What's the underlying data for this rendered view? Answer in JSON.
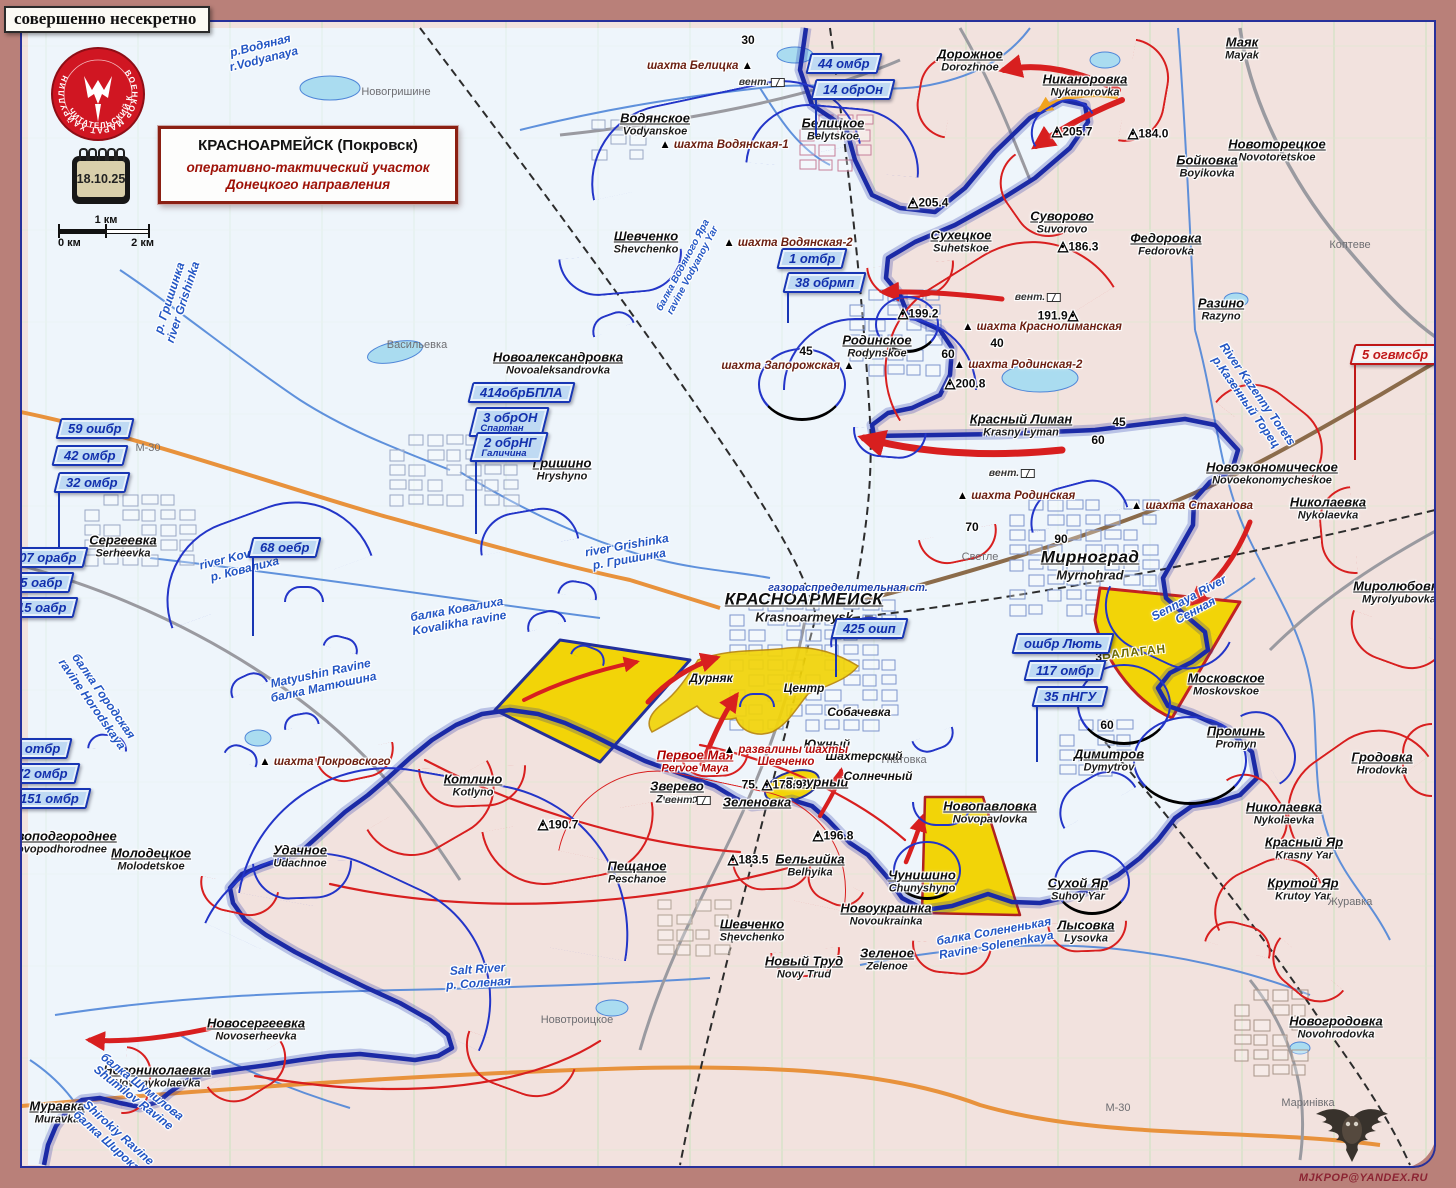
{
  "header": {
    "classification": "совершенно несекретно",
    "logo_line1": "ВОЕНКОР МАРАТ ХАЙРУЛЛИН",
    "logo_line2": "ЧИТАТЕЛЬСКИЙ КЛУБ",
    "date": "18.10.25",
    "title_line1": "КРАСНОАРМЕЙСК (Покровск)",
    "title_line2": "оперативно-тактический участок",
    "title_line3": "Донецкого направления",
    "scale": {
      "top": "1 км",
      "left": "0 км",
      "right": "2 км"
    },
    "watermark": "MJKPOP@YANDEX.RU"
  },
  "colors": {
    "front_line": "#1b2aa6",
    "enemy": "#d81f1f",
    "friendly": "#2335c8",
    "contested": "#f2d408",
    "ua_area": "#eef5fb",
    "ru_area": "#f2e2de",
    "frame": "#b98079"
  },
  "map": {
    "towns": [
      {
        "ru": "КРАСНОАРМЕЙСК",
        "en": "Krasnoarmeysk",
        "x": 804,
        "y": 607,
        "s": "lg"
      },
      {
        "ru": "Мирноград",
        "en": "Myrnohrad",
        "x": 1090,
        "y": 565,
        "s": "lg"
      },
      {
        "ru": "Дорожное",
        "en": "Dorozhnoe",
        "x": 970,
        "y": 60
      },
      {
        "ru": "Никаноровка",
        "en": "Nykanorovka",
        "x": 1085,
        "y": 85
      },
      {
        "ru": "Маяк",
        "en": "Mayak",
        "x": 1242,
        "y": 48
      },
      {
        "ru": "Новоторецкое",
        "en": "Novotoretskoe",
        "x": 1277,
        "y": 150
      },
      {
        "ru": "Бойковка",
        "en": "Boyikovka",
        "x": 1207,
        "y": 166
      },
      {
        "ru": "Суворово",
        "en": "Suvorovo",
        "x": 1062,
        "y": 222
      },
      {
        "ru": "Федоровка",
        "en": "Fedorovka",
        "x": 1166,
        "y": 244
      },
      {
        "ru": "Разино",
        "en": "Razyno",
        "x": 1221,
        "y": 309
      },
      {
        "ru": "Водянское",
        "en": "Vodyanskoe",
        "x": 655,
        "y": 124
      },
      {
        "ru": "Белицкое",
        "en": "Belytskoe",
        "x": 833,
        "y": 129
      },
      {
        "ru": "Сухецкое",
        "en": "Suhetskoe",
        "x": 961,
        "y": 241
      },
      {
        "ru": "Шевченко",
        "en": "Shevchenko",
        "x": 646,
        "y": 242
      },
      {
        "ru": "Родинское",
        "en": "Rodynskoe",
        "x": 877,
        "y": 346
      },
      {
        "ru": "Красный Лиман",
        "en": "Krasny Lyman",
        "x": 1021,
        "y": 425
      },
      {
        "ru": "Новоэкономическое",
        "en": "Novoekonomycheskoe",
        "x": 1272,
        "y": 473
      },
      {
        "ru": "Николаевка",
        "en": "Nykolaevka",
        "x": 1328,
        "y": 508
      },
      {
        "ru": "Миролюбовка",
        "en": "Myrolyubovka",
        "x": 1399,
        "y": 592
      },
      {
        "ru": "Новоалександровка",
        "en": "Novoaleksandrovka",
        "x": 558,
        "y": 363
      },
      {
        "ru": "Гришино",
        "en": "Hryshyno",
        "x": 562,
        "y": 469
      },
      {
        "ru": "Сергеевка",
        "en": "Serheevka",
        "x": 123,
        "y": 546
      },
      {
        "ru": "Московское",
        "en": "Moskovskoe",
        "x": 1226,
        "y": 684
      },
      {
        "ru": "Димитров",
        "en": "Dymytrov",
        "x": 1109,
        "y": 760
      },
      {
        "ru": "Проминь",
        "en": "Promyn",
        "x": 1236,
        "y": 737
      },
      {
        "ru": "Гродовка",
        "en": "Hrodovka",
        "x": 1382,
        "y": 763
      },
      {
        "ru": "Николаевка",
        "en": "Nykolaevka",
        "x": 1284,
        "y": 813
      },
      {
        "ru": "Красный Яр",
        "en": "Krasny Yar",
        "x": 1304,
        "y": 848
      },
      {
        "ru": "Крутой Яр",
        "en": "Krutoy Yar",
        "x": 1303,
        "y": 889
      },
      {
        "ru": "Сухой Яр",
        "en": "Suhoy Yar",
        "x": 1078,
        "y": 889
      },
      {
        "ru": "Лысовка",
        "en": "Lysovka",
        "x": 1086,
        "y": 931
      },
      {
        "ru": "Котлино",
        "en": "Kotlyno",
        "x": 473,
        "y": 785
      },
      {
        "ru": "Зверево",
        "en": "Zverevo",
        "x": 677,
        "y": 792
      },
      {
        "ru": "Первое Мая",
        "en": "Pervoe Maya",
        "x": 695,
        "y": 761,
        "c": "#b00000"
      },
      {
        "ru": "Лазурный",
        "en": "",
        "x": 816,
        "y": 782
      },
      {
        "ru": "Зеленовка",
        "en": "",
        "x": 757,
        "y": 802
      },
      {
        "ru": "Новопавловка",
        "en": "Novopavlovka",
        "x": 990,
        "y": 812
      },
      {
        "ru": "Чунишино",
        "en": "Chunyshyno",
        "x": 922,
        "y": 881
      },
      {
        "ru": "Бельгийка",
        "en": "Belhyika",
        "x": 810,
        "y": 865
      },
      {
        "ru": "Пещаное",
        "en": "Peschanoe",
        "x": 637,
        "y": 872
      },
      {
        "ru": "Новоукраинка",
        "en": "Novoukrainka",
        "x": 886,
        "y": 914
      },
      {
        "ru": "Шевченко",
        "en": "Shevchenko",
        "x": 752,
        "y": 930
      },
      {
        "ru": "Новый Труд",
        "en": "Novy Trud",
        "x": 804,
        "y": 967
      },
      {
        "ru": "Зеленое",
        "en": "Zelenoe",
        "x": 887,
        "y": 959
      },
      {
        "ru": "Новоподгороднее",
        "en": "Novopodhorodnee",
        "x": 58,
        "y": 842
      },
      {
        "ru": "Молодецкое",
        "en": "Molodetskoe",
        "x": 151,
        "y": 859
      },
      {
        "ru": "Удачное",
        "en": "Udachnoe",
        "x": 300,
        "y": 856
      },
      {
        "ru": "Новосергеевка",
        "en": "Novoserheevka",
        "x": 256,
        "y": 1029
      },
      {
        "ru": "Новониколаевка",
        "en": "Novonykolaevka",
        "x": 157,
        "y": 1076
      },
      {
        "ru": "Муравка",
        "en": "Muravka",
        "x": 57,
        "y": 1112
      },
      {
        "ru": "Новогродовка",
        "en": "Novohrodovka",
        "x": 1336,
        "y": 1027
      }
    ],
    "districts": [
      {
        "t": "Дурняк",
        "x": 711,
        "y": 678
      },
      {
        "t": "Центр",
        "x": 804,
        "y": 688
      },
      {
        "t": "Собачевка",
        "x": 859,
        "y": 712
      },
      {
        "t": "Южный",
        "x": 827,
        "y": 744
      },
      {
        "t": "Шахтерский",
        "x": 864,
        "y": 756
      },
      {
        "t": "Солнечный",
        "x": 878,
        "y": 776
      }
    ],
    "mines": [
      {
        "t": "шахта Белицка",
        "x": 700,
        "y": 66,
        "tri": "r"
      },
      {
        "t": "шахта Водянская-1",
        "x": 724,
        "y": 145,
        "tri": "l"
      },
      {
        "t": "шахта Водянская-2",
        "x": 788,
        "y": 243,
        "tri": "l"
      },
      {
        "t": "шахта Запорожская",
        "x": 788,
        "y": 366,
        "tri": "r"
      },
      {
        "t": "шахта Краснолиманская",
        "x": 1042,
        "y": 327,
        "tri": "l"
      },
      {
        "t": "шахта Родинская-2",
        "x": 1018,
        "y": 365,
        "tri": "l"
      },
      {
        "t": "шахта Родинская",
        "x": 1016,
        "y": 496,
        "tri": "l"
      },
      {
        "t": "шахта Стаханова",
        "x": 1192,
        "y": 506,
        "tri": "l"
      },
      {
        "t": "шахта Покровского",
        "x": 325,
        "y": 762,
        "tri": "l"
      },
      {
        "t": "развалины шахты\nШевченко",
        "x": 786,
        "y": 756,
        "tri": "l",
        "red": true
      }
    ],
    "gas_station": {
      "t": "газораспределительная ст.",
      "x": 848,
      "y": 588
    },
    "heights": [
      {
        "v": "205.7",
        "x": 1072,
        "y": 131
      },
      {
        "v": "205.4",
        "x": 928,
        "y": 202
      },
      {
        "v": "184.0",
        "x": 1148,
        "y": 133
      },
      {
        "v": "186.3",
        "x": 1078,
        "y": 246
      },
      {
        "v": "191.9",
        "x": 1058,
        "y": 315,
        "flip": true
      },
      {
        "v": "199.2",
        "x": 918,
        "y": 313
      },
      {
        "v": "200.8",
        "x": 965,
        "y": 383
      },
      {
        "v": "178.9",
        "x": 772,
        "y": 784,
        "pre": "75."
      },
      {
        "v": "190.7",
        "x": 558,
        "y": 824
      },
      {
        "v": "183.5",
        "x": 748,
        "y": 859
      },
      {
        "v": "196.8",
        "x": 833,
        "y": 835
      }
    ],
    "numbers": [
      {
        "v": "30",
        "x": 748,
        "y": 40
      },
      {
        "v": "40",
        "x": 997,
        "y": 343
      },
      {
        "v": "45",
        "x": 806,
        "y": 351
      },
      {
        "v": "60",
        "x": 948,
        "y": 354
      },
      {
        "v": "45",
        "x": 1119,
        "y": 422
      },
      {
        "v": "60",
        "x": 1098,
        "y": 440
      },
      {
        "v": "70",
        "x": 972,
        "y": 527
      },
      {
        "v": "90",
        "x": 1061,
        "y": 539
      },
      {
        "v": "38",
        "x": 1102,
        "y": 657
      },
      {
        "v": "60",
        "x": 1107,
        "y": 725
      }
    ],
    "vents": [
      {
        "x": 762,
        "y": 82
      },
      {
        "x": 1038,
        "y": 297
      },
      {
        "x": 1012,
        "y": 473
      },
      {
        "x": 688,
        "y": 800
      }
    ],
    "rivers": [
      {
        "t": "р.Водяная\nr.Vodyanaya",
        "x": 262,
        "y": 52,
        "rot": -14
      },
      {
        "t": "балка Водяного Яра\nravine Vodyanoy Yar",
        "x": 688,
        "y": 268,
        "rot": -62,
        "fs": 10
      },
      {
        "t": "р. Гришинка\nriver Grishinka",
        "x": 176,
        "y": 300,
        "rot": -72
      },
      {
        "t": "river Grishinka\nр. Гришинка",
        "x": 628,
        "y": 552,
        "rot": -10
      },
      {
        "t": "river Kovalikha\nр. Ковалиха",
        "x": 243,
        "y": 562,
        "rot": -14
      },
      {
        "t": "балка Ковалиха\nKovalikha ravine",
        "x": 458,
        "y": 616,
        "rot": -10
      },
      {
        "t": "Matyushin Ravine\nбалка Матюшина",
        "x": 322,
        "y": 680,
        "rot": -12
      },
      {
        "t": "балка Городская\nravine Horodskaya",
        "x": 98,
        "y": 700,
        "rot": 55
      },
      {
        "t": "River Kazenny Torets\nр.Казенный Торец",
        "x": 1252,
        "y": 398,
        "rot": 55
      },
      {
        "t": "Sennaya River\nСенная",
        "x": 1192,
        "y": 604,
        "rot": -28
      },
      {
        "t": "Salt River\nр. Соленая",
        "x": 478,
        "y": 976,
        "rot": -4
      },
      {
        "t": "балка Шумилова\nShumilov Ravine",
        "x": 138,
        "y": 1092,
        "rot": 38
      },
      {
        "t": "Shirokiy Ravine\nбалка Широкая",
        "x": 114,
        "y": 1138,
        "rot": 42
      },
      {
        "t": "балка Солененькая\nRavine Solenenkaya",
        "x": 995,
        "y": 938,
        "rot": -10
      }
    ],
    "tiny": [
      {
        "t": "Новогришине",
        "x": 396,
        "y": 92
      },
      {
        "t": "Васильевка",
        "x": 417,
        "y": 345
      },
      {
        "t": "Светле",
        "x": 980,
        "y": 557
      },
      {
        "t": "Гнатовка",
        "x": 904,
        "y": 760
      },
      {
        "t": "Коптеве",
        "x": 1350,
        "y": 245
      },
      {
        "t": "Журавка",
        "x": 1350,
        "y": 902
      },
      {
        "t": "Маринівка",
        "x": 1308,
        "y": 1103
      },
      {
        "t": "Новотроицкое",
        "x": 577,
        "y": 1020
      },
      {
        "t": "М-30",
        "x": 148,
        "y": 448
      },
      {
        "t": "М-30",
        "x": 1118,
        "y": 1108
      }
    ],
    "zone_label": {
      "t": "БАЛАГАН",
      "x": 1134,
      "y": 652
    },
    "flags": [
      {
        "l": "44 омбр",
        "x": 808,
        "y": 53,
        "pole": 0
      },
      {
        "l": "14 обрОн",
        "x": 813,
        "y": 79,
        "pole": 36
      },
      {
        "l": "1 отбр",
        "x": 779,
        "y": 248,
        "pole": 0
      },
      {
        "l": "38 обрмп",
        "x": 785,
        "y": 272,
        "pole": 30
      },
      {
        "l": "59 ошбр",
        "x": 58,
        "y": 418,
        "pole": 0
      },
      {
        "l": "42 омбр",
        "x": 54,
        "y": 445,
        "pole": 0
      },
      {
        "l": "32 омбр",
        "x": 56,
        "y": 472,
        "pole": 60
      },
      {
        "l": "414обрБПЛА",
        "x": 470,
        "y": 382,
        "pole": 0
      },
      {
        "l": "3 обрОН",
        "sub": "Спартан",
        "x": 472,
        "y": 407,
        "pole": 0
      },
      {
        "l": "2 обрНГ",
        "sub": "Галичина",
        "x": 473,
        "y": 432,
        "pole": 72
      },
      {
        "l": "107 орабр",
        "x": 2,
        "y": 547,
        "pole": 0
      },
      {
        "l": "55 оабр",
        "x": 3,
        "y": 572,
        "pole": 0
      },
      {
        "l": "15 оабр",
        "x": 7,
        "y": 597,
        "pole": 140
      },
      {
        "l": "68 оебр",
        "x": 250,
        "y": 537,
        "pole": 78
      },
      {
        "l": "2 отбр",
        "x": 4,
        "y": 738,
        "pole": 0
      },
      {
        "l": "72 омбр",
        "x": 6,
        "y": 763,
        "pole": 0
      },
      {
        "l": "151 омбр",
        "x": 10,
        "y": 788,
        "pole": 0
      },
      {
        "l": "425 ошп",
        "x": 833,
        "y": 618,
        "pole": 38
      },
      {
        "l": "ошбр Лють",
        "x": 1014,
        "y": 633,
        "pole": 0
      },
      {
        "l": "117 омбр",
        "x": 1026,
        "y": 660,
        "pole": 0
      },
      {
        "l": "35 пНГУ",
        "x": 1034,
        "y": 686,
        "pole": 55
      },
      {
        "l": "5 огвмсбр",
        "x": 1352,
        "y": 344,
        "pole": 95,
        "red": true
      }
    ]
  }
}
